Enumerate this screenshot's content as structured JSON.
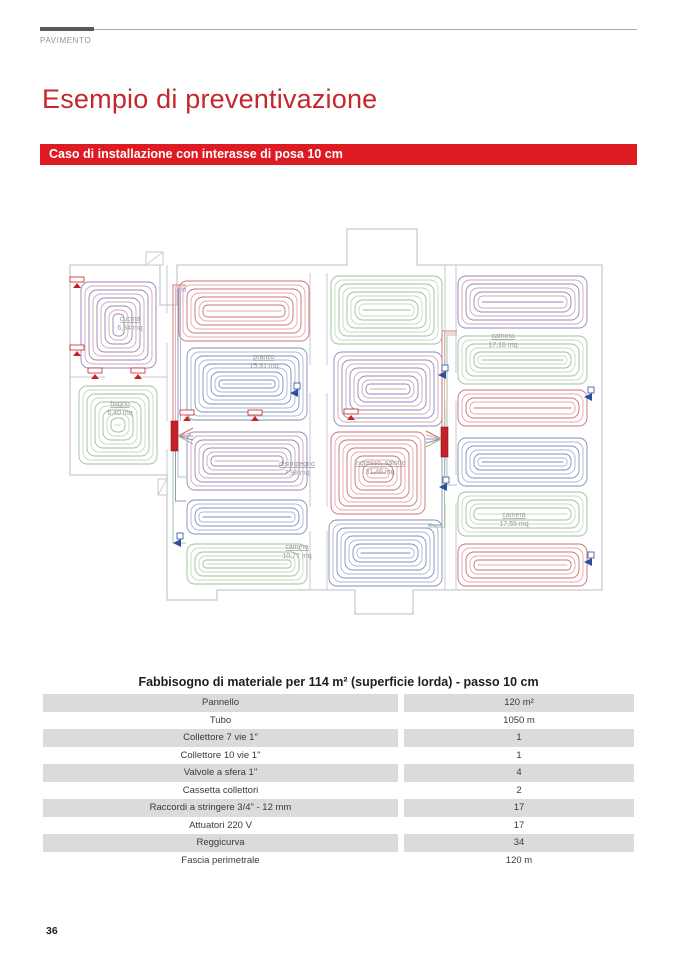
{
  "page": {
    "header": {
      "section_label": "PAVIMENTO"
    },
    "title": "Esempio di preventivazione",
    "banner": "Caso di installazione con interasse di posa 10 cm",
    "page_number": "36"
  },
  "floorplan": {
    "rooms": [
      {
        "name": "cucina",
        "area": "6,84 mq"
      },
      {
        "name": "bagno",
        "area": "6,40 mq"
      },
      {
        "name": "pranzo",
        "area": "15,91 mq"
      },
      {
        "name": "disimpegno",
        "area": "7,98 mq"
      },
      {
        "name": "camera",
        "area": "10,77 mq"
      },
      {
        "name": "ingresso, salotto",
        "area": "31,46 mq"
      },
      {
        "name": "camera",
        "area": "17,16 mq"
      },
      {
        "name": "camera",
        "area": "17,55 mq"
      }
    ],
    "coil_colors": {
      "red": [
        "#c96f74",
        "#e2a8ac"
      ],
      "blue": [
        "#7e8fb4",
        "#a9b5d1"
      ],
      "green": [
        "#9dbf97",
        "#c5d9c0"
      ],
      "violet": [
        "#8f87c0",
        "#d5a4b3"
      ]
    },
    "wall_color": "#c9c9cd",
    "label_color": "#9a9a9a",
    "manifold_color": "#c32127",
    "valve_color": "#2c4f9e",
    "marker_color": "#c82127"
  },
  "table": {
    "title": "Fabbisogno di materiale per 114 m² (superficie lorda) - passo 10 cm",
    "rows": [
      {
        "label": "Pannello",
        "value": "120 m²"
      },
      {
        "label": "Tubo",
        "value": "1050 m"
      },
      {
        "label": "Collettore 7 vie 1\"",
        "value": "1"
      },
      {
        "label": "Collettore 10 vie 1\"",
        "value": "1"
      },
      {
        "label": "Valvole a sfera 1\"",
        "value": "4"
      },
      {
        "label": "Cassetta collettori",
        "value": "2"
      },
      {
        "label": "Raccordi a stringere 3/4\" - 12 mm",
        "value": "17"
      },
      {
        "label": "Attuatori 220 V",
        "value": "17"
      },
      {
        "label": "Reggicurva",
        "value": "34"
      },
      {
        "label": "Fascia perimetrale",
        "value": "120 m"
      }
    ]
  }
}
